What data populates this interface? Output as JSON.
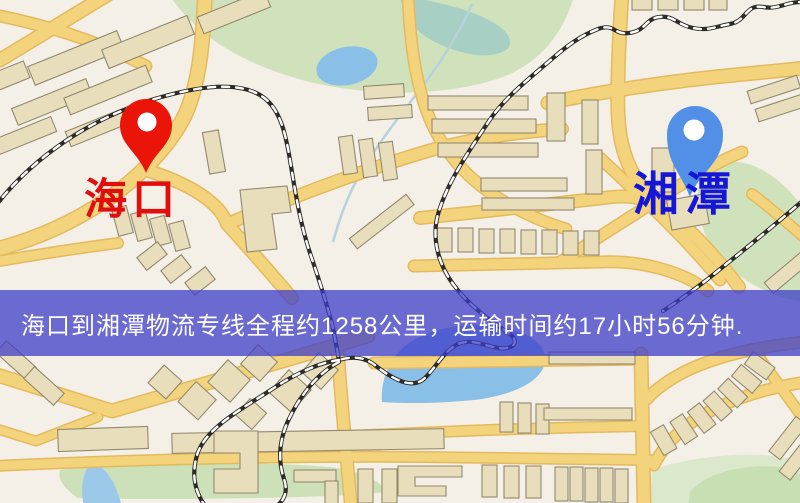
{
  "banner": {
    "text": "海口到湘潭物流专线全程约1258公里，运输时间约17小时56分钟.",
    "background_color": "#3e3eca",
    "text_color": "#ffffff"
  },
  "markers": {
    "origin": {
      "label": "海口",
      "pin_color": "#ea1408",
      "label_color": "#e10e0e"
    },
    "destination": {
      "label": "湘潭",
      "pin_color": "#5290e8",
      "label_color": "#1616d6"
    }
  },
  "route": {
    "origin": "海口",
    "destination": "湘潭",
    "service": "物流专线",
    "distance_text": "全程约1258公里",
    "duration_text": "运输时间约17小时56分钟"
  },
  "map_colors": {
    "background": "#f4efe7",
    "road": "#f3d37b",
    "road_casing": "#e4ba5e",
    "park": "#cfe2bc",
    "water": "#8abfe8",
    "building": "#e9debb",
    "railway": "#2e2a26"
  }
}
